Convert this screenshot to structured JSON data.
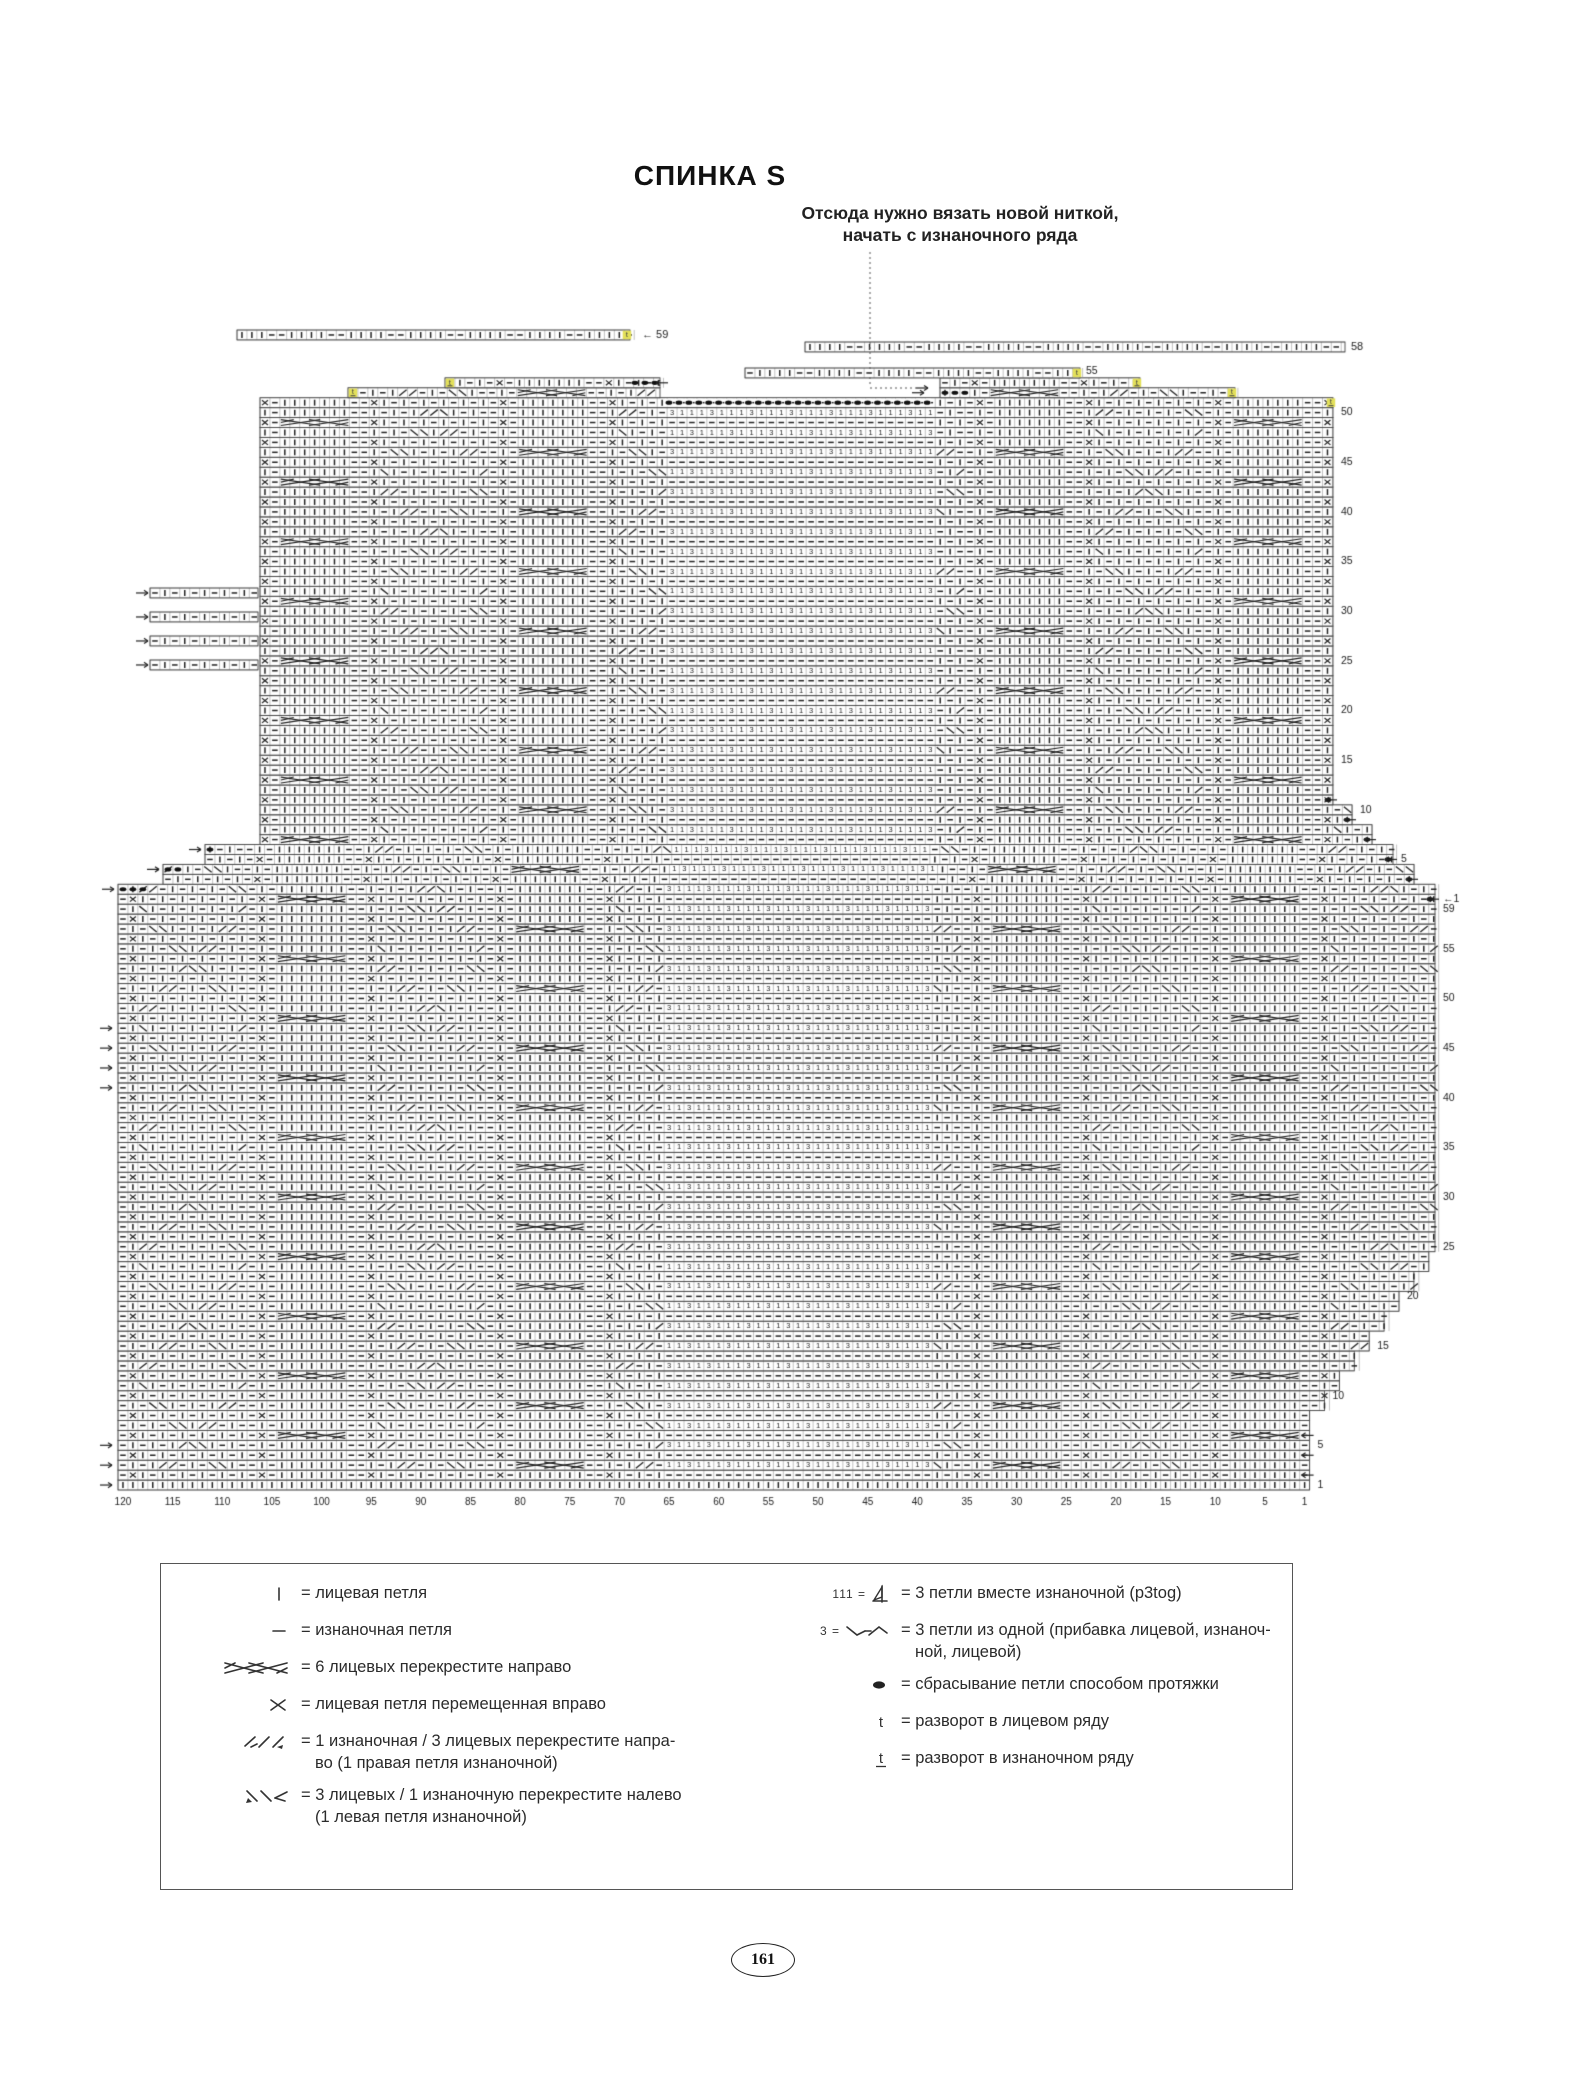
{
  "page": {
    "title": "СПИНКА S",
    "page_number": "161"
  },
  "annotation": {
    "line1": "Отсюда нужно вязать новой ниткой,",
    "line2": "начать с изнаночного ряда"
  },
  "chart": {
    "colors": {
      "grid": "#8f8f8f",
      "border": "#444444",
      "symbol": "#222222",
      "highlight": "#e3e05a",
      "background": "#ffffff"
    },
    "column_labels": [
      120,
      115,
      110,
      105,
      100,
      95,
      90,
      85,
      80,
      75,
      70,
      65,
      60,
      55,
      50,
      45,
      40,
      35,
      30,
      25,
      20,
      15,
      10,
      5,
      1
    ],
    "lower_row_labels": [
      1,
      5,
      10,
      15,
      20,
      25,
      30,
      35,
      40,
      45,
      50,
      55,
      59
    ],
    "upper_row_labels": [
      "1",
      5,
      10,
      15,
      20,
      25,
      30,
      35,
      40,
      45,
      50
    ],
    "special_labels": {
      "upper_first": "←1",
      "left_strip": "← 59",
      "right_strip": "58",
      "neck_side": "55"
    },
    "symbols_key": [
      "knit",
      "purl",
      "cable6-right",
      "cross-right",
      "p1k3-cross-right",
      "k3p1-cross-left",
      "p3tog",
      "inc-3-from-1",
      "drop-stitch",
      "turn-rs",
      "turn-ws"
    ],
    "geometry": {
      "cell": 9.93,
      "body_left": 118,
      "body_cols": 120,
      "bottom_y": 1490,
      "lower_rows": 59,
      "upper_rows": 53,
      "mesh_left": 664,
      "mesh_right": 930,
      "sleeve_right_max": 1435,
      "upper_left_inset": 260,
      "upper_right_edge": 1333
    }
  },
  "legend": {
    "left": [
      {
        "type": "knit",
        "text": "= лицевая петля"
      },
      {
        "type": "purl",
        "text": "= изнаночная петля"
      },
      {
        "type": "cable6",
        "text": "= 6 лицевых перекрестите направо"
      },
      {
        "type": "cross-right",
        "text": "= лицевая петля перемещенная вправо"
      },
      {
        "type": "p1k3-right",
        "text": "= 1 изнаночная / 3 лицевых перекрестите напра-",
        "text2": "во (1 правая петля изнаночной)"
      },
      {
        "type": "k3p1-left",
        "text": "= 3 лицевых / 1 изнаночную перекрестите налево",
        "text2": "(1 левая петля изнаночной)"
      }
    ],
    "right": [
      {
        "prefix": "111 =",
        "type": "p3tog",
        "text": "= 3 петли вместе изнаночной (p3tog)"
      },
      {
        "prefix": "3 =",
        "type": "inc3",
        "text": "= 3 петли из одной (прибавка лицевой, изнаноч-",
        "text2": "ной, лицевой)"
      },
      {
        "type": "drop",
        "text": "= сбрасывание петли способом протяжки"
      },
      {
        "type": "turn-rs",
        "text": "= разворот в лицевом ряду"
      },
      {
        "type": "turn-ws",
        "text": "= разворот в изнаночном ряду"
      }
    ]
  }
}
